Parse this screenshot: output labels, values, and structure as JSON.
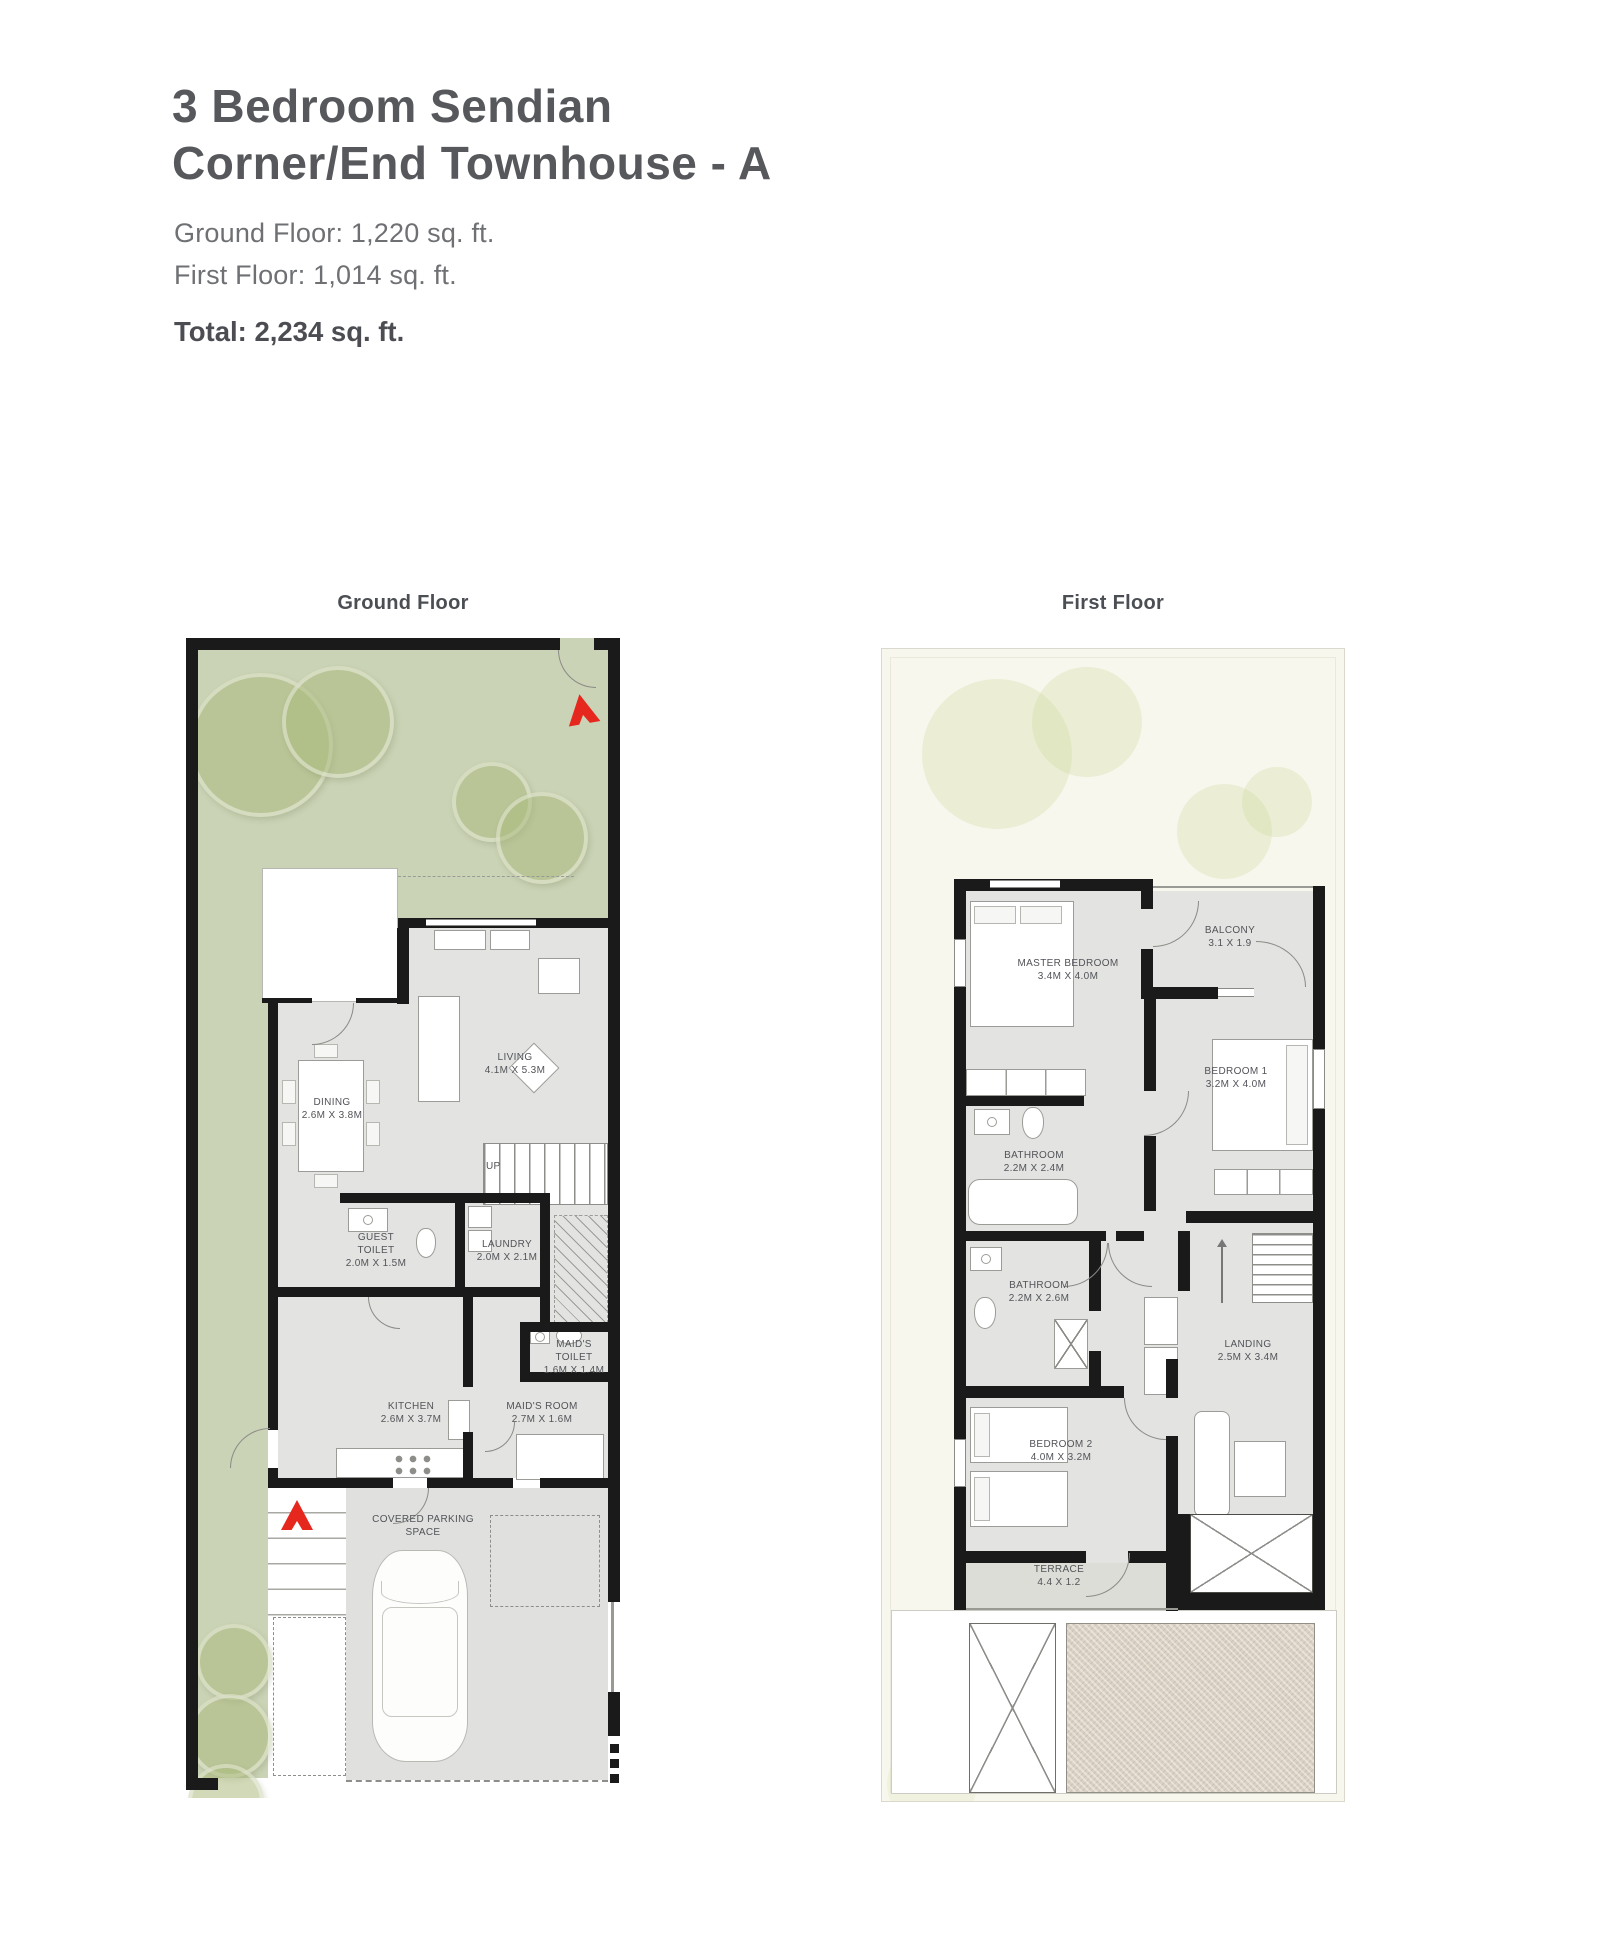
{
  "header": {
    "title_line1": "3 Bedroom Sendian",
    "title_line2": "Corner/End Townhouse - A",
    "ground_floor_area": "Ground Floor: 1,220 sq. ft.",
    "first_floor_area": "First Floor: 1,014 sq. ft.",
    "total_area": "Total: 2,234 sq. ft."
  },
  "floors": {
    "ground": {
      "label": "Ground Floor",
      "stairs_label": "UP",
      "rooms": {
        "dining": {
          "name": "DINING",
          "dims": "2.6M X 3.8M"
        },
        "living": {
          "name": "LIVING",
          "dims": "4.1M X 5.3M"
        },
        "guest_toilet": {
          "name": "GUEST TOILET",
          "dims": "2.0M X 1.5M"
        },
        "laundry": {
          "name": "LAUNDRY",
          "dims": "2.0M X 2.1M"
        },
        "maids_toilet": {
          "name": "MAID'S TOILET",
          "dims": "1.6M X 1.4M"
        },
        "kitchen": {
          "name": "KITCHEN",
          "dims": "2.6M X 3.7M"
        },
        "maids_room": {
          "name": "MAID'S ROOM",
          "dims": "2.7M X 1.6M"
        },
        "parking": {
          "name": "COVERED PARKING SPACE",
          "dims": ""
        }
      }
    },
    "first": {
      "label": "First Floor",
      "rooms": {
        "master_bedroom": {
          "name": "MASTER BEDROOM",
          "dims": "3.4M X 4.0M"
        },
        "balcony": {
          "name": "BALCONY",
          "dims": "3.1 X 1.9"
        },
        "bedroom1": {
          "name": "BEDROOM 1",
          "dims": "3.2M X 4.0M"
        },
        "bathroom1": {
          "name": "BATHROOM",
          "dims": "2.2M X 2.4M"
        },
        "bathroom2": {
          "name": "BATHROOM",
          "dims": "2.2M X 2.6M"
        },
        "landing": {
          "name": "LANDING",
          "dims": "2.5M X 3.4M"
        },
        "bedroom2": {
          "name": "BEDROOM 2",
          "dims": "4.0M X 3.2M"
        },
        "terrace": {
          "name": "TERRACE",
          "dims": "4.4 X 1.2"
        }
      }
    }
  },
  "icons": {
    "entrance_arrow": "red-triangle-north"
  },
  "colors": {
    "accent_red": "#e6271e",
    "garden_green": "#cbd3b6",
    "interior_gray": "#e3e4e1",
    "wall_black": "#1a1a1a",
    "panel_ivory": "#f8f7ee",
    "sand_texture": "#d9d1c3"
  }
}
